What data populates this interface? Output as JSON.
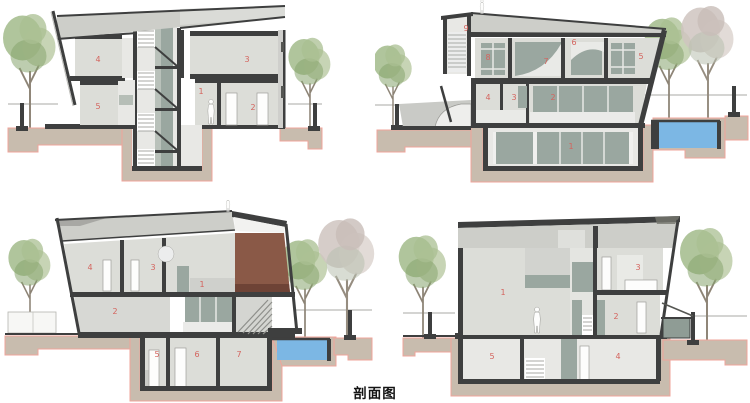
{
  "caption": "剖面图",
  "drawing_type": "architectural-cross-sections",
  "palette": {
    "dark": "#3e3f3f",
    "wall": "#dcddd8",
    "wall2": "#e8e8e5",
    "roof": "#cdcec9",
    "glass": "#9aa7a0",
    "tan": "#c8bcae",
    "pink": "#efa49b",
    "pool": "#7cb7e4",
    "brick": "#8a5947",
    "label-red": "#d4645e"
  },
  "sections": [
    {
      "name": "section-top-left",
      "rooms": [
        "4",
        "3",
        "5",
        "1",
        "2"
      ]
    },
    {
      "name": "section-top-right",
      "rooms": [
        "9",
        "8",
        "7",
        "6",
        "5",
        "4",
        "3",
        "2",
        "1"
      ]
    },
    {
      "name": "section-bottom-left",
      "rooms": [
        "4",
        "3",
        "1",
        "2",
        "5",
        "6",
        "7"
      ]
    },
    {
      "name": "section-bottom-right",
      "rooms": [
        "1",
        "3",
        "2",
        "5",
        "4"
      ]
    }
  ],
  "icons": {
    "tree_green": "tree-icon",
    "tree_pale": "pale-tree-icon",
    "person": "person-icon",
    "pool": "swimming-pool",
    "stairs": "staircase"
  }
}
